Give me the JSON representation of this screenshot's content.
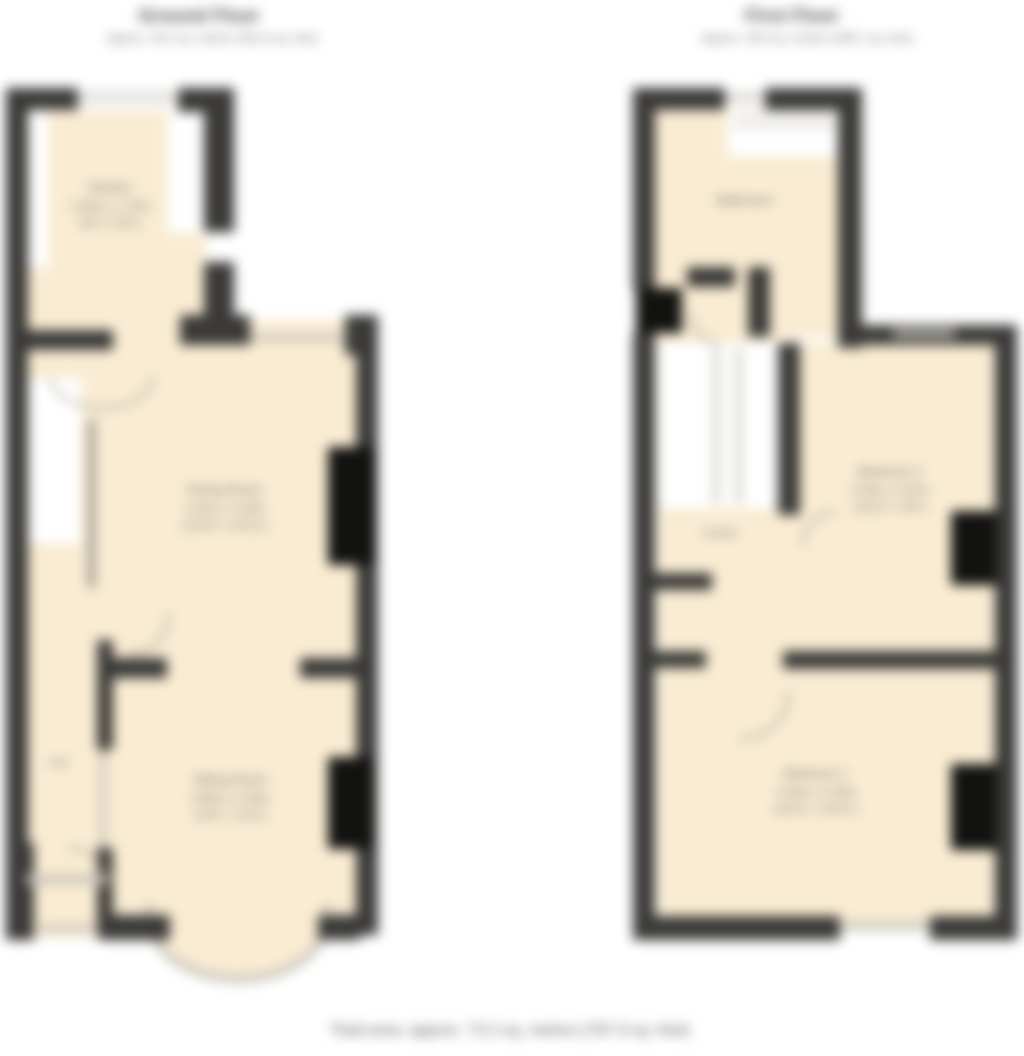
{
  "colors": {
    "room_fill": "#f9ecd3",
    "wall": "#3b3a38",
    "feature_black": "#121210",
    "window_line": "#c9c4ba",
    "label_text": "#6a6a68",
    "title_text": "#4f4f4d"
  },
  "ground_floor": {
    "title": "Ground Floor",
    "subtitle": "Approx. 36.4 sq. metres (391.8 sq. feet)",
    "rooms": [
      {
        "id": "kitchen",
        "name": "Kitchen",
        "dims_metric": "1.93m x 1.75m",
        "dims_imperial": "(6'4\" x 5'9\")"
      },
      {
        "id": "dining-room",
        "name": "Dining Room",
        "dims_metric": "4.22m x 3.33m",
        "dims_imperial": "(13'10\" x 10'11\")"
      },
      {
        "id": "sitting-room",
        "name": "Sitting Room",
        "dims_metric": "3.96m x 3.35m",
        "dims_imperial": "(13'0\" x 11'0\")"
      },
      {
        "id": "hall",
        "name": "Hall"
      }
    ]
  },
  "first_floor": {
    "title": "First Floor",
    "subtitle": "Approx. 36.8 sq. metres (396.1 sq. feet)",
    "rooms": [
      {
        "id": "bathroom",
        "name": "Bathroom"
      },
      {
        "id": "bedroom-2",
        "name": "Bedroom 2",
        "dims_metric": "3.33m x 2.87m",
        "dims_imperial": "(10'11\" x 9'5\")"
      },
      {
        "id": "landing",
        "name": "Landing"
      },
      {
        "id": "bedroom-1",
        "name": "Bedroom 1",
        "dims_metric": "4.24m x 3.33m",
        "dims_imperial": "(13'11\" x 10'11\")"
      }
    ]
  },
  "footer": {
    "total_area": "Total area: approx. 73.2 sq. metres (787.9 sq. feet)"
  }
}
